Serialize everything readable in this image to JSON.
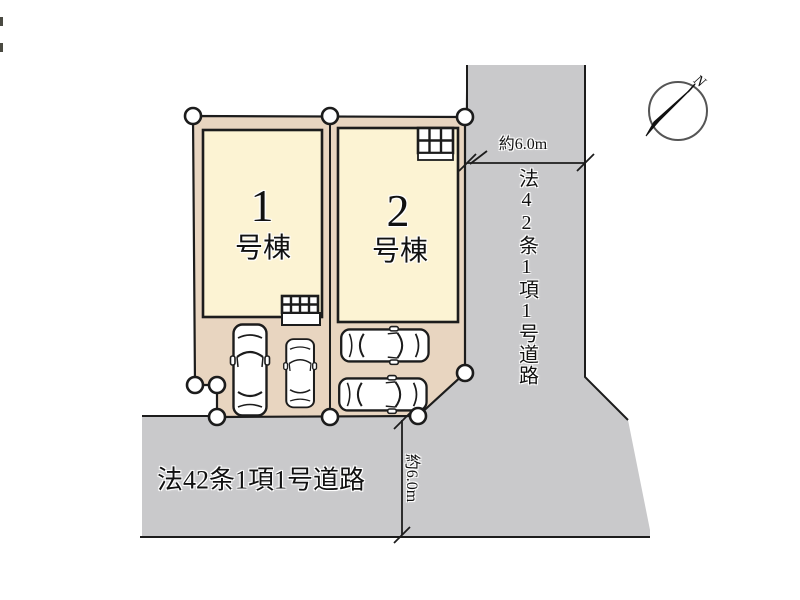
{
  "buildings": [
    {
      "number": "1",
      "suffix": "号棟"
    },
    {
      "number": "2",
      "suffix": "号棟"
    }
  ],
  "roads": {
    "right": {
      "label": "法42条1項1号道路",
      "width_dim": "約6.0m"
    },
    "bottom": {
      "label": "法42条1項1号道路",
      "width_dim": "約6.0m"
    }
  },
  "compass": {
    "north": "N"
  },
  "colors": {
    "land": "#e8d5c0",
    "building": "#fcf3d3",
    "road": "#c9c9cb",
    "line": "#1c1c1c"
  }
}
